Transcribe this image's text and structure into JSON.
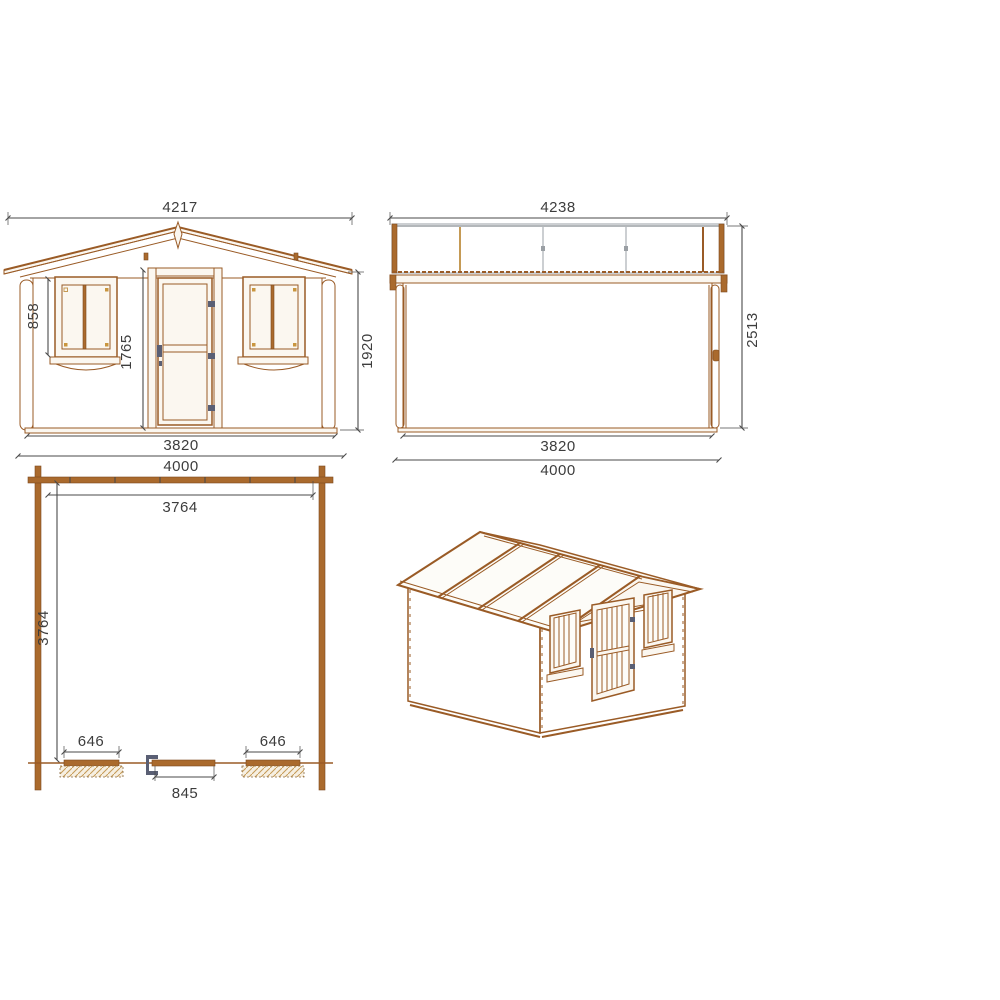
{
  "drawing_type": "log-cabin-technical-drawing",
  "views": {
    "front": {
      "label": "front-elevation",
      "overall_width": "4217",
      "window_height": "858",
      "door_height": "1765",
      "eave_height": "1920",
      "wall_width": "3820",
      "base_width": "4000"
    },
    "side": {
      "label": "side-elevation",
      "overall_width": "4238",
      "overall_height": "2513",
      "wall_width": "3820",
      "base_width": "4000"
    },
    "plan": {
      "label": "floor-plan",
      "inner_width": "3764",
      "inner_depth": "3764",
      "window_left_width": "646",
      "window_right_width": "646",
      "door_width": "845"
    },
    "perspective": {
      "label": "3d-view"
    }
  },
  "colors": {
    "background": "#ffffff",
    "wood_line": "#9a5b26",
    "wood_dark": "#7d4a1e",
    "wood_fill": "#fbf7f0",
    "wood_solid": "#aa6a2d",
    "tan_line": "#c59a55",
    "dim_line": "#4a4a4a",
    "dim_text": "#3d3d3d",
    "hardware": "#5a5f74",
    "roof_gray": "#9a9fa4"
  }
}
